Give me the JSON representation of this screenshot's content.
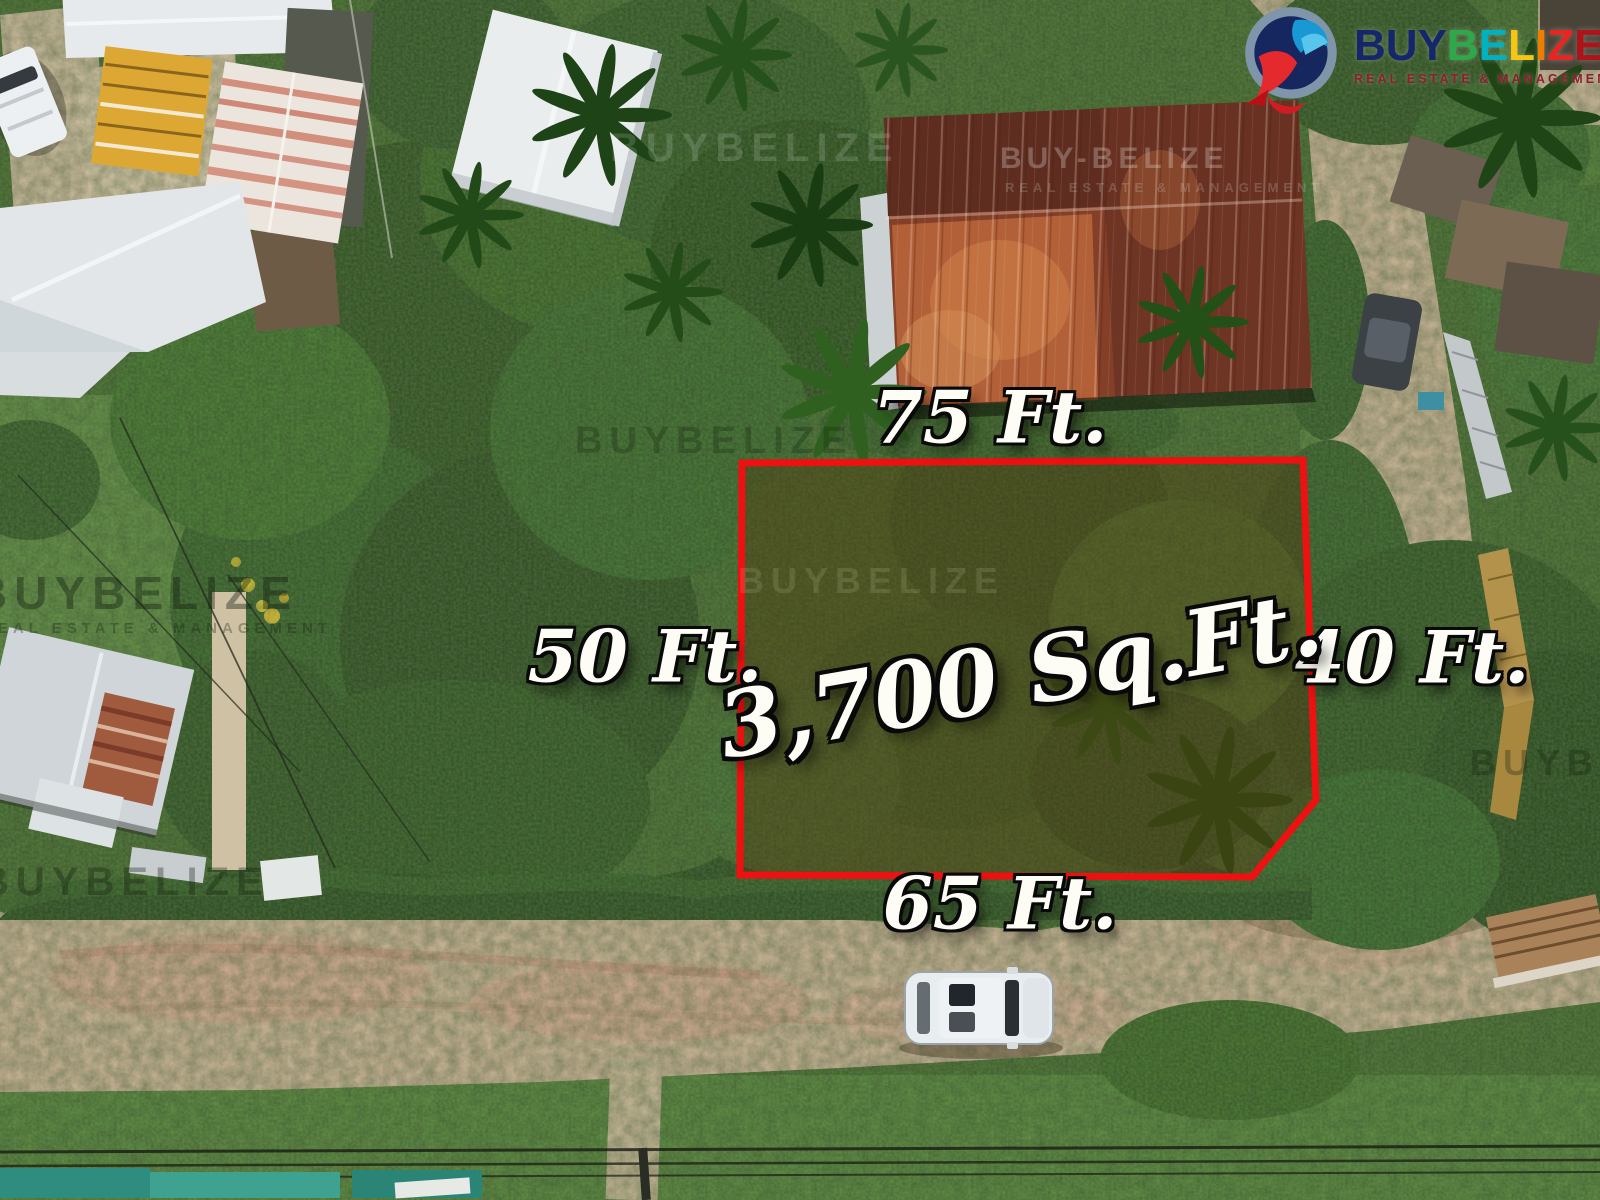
{
  "brand": {
    "logo_text": "BUYBELIZE",
    "letters": [
      {
        "char": "B",
        "color": "#15266b"
      },
      {
        "char": "U",
        "color": "#15266b"
      },
      {
        "char": "Y",
        "color": "#15266b"
      },
      {
        "char": "B",
        "color": "#2fa84c"
      },
      {
        "char": "E",
        "color": "#00b2c0"
      },
      {
        "char": "L",
        "color": "#f6c612"
      },
      {
        "char": "I",
        "color": "#ef7d00"
      },
      {
        "char": "Z",
        "color": "#e8251f"
      },
      {
        "char": "E",
        "color": "#b01219"
      }
    ],
    "tagline": "REAL ESTATE & MANAGEMENT",
    "icon": "toucan-bird-logo"
  },
  "annotations": {
    "area": "3,700 Sq.Ft.",
    "side_top": "75 Ft.",
    "side_left": "50 Ft.",
    "side_right": "40 Ft.",
    "side_bottom": "65 Ft.",
    "boundary_color": "#ee1111"
  },
  "watermarks": {
    "primary": "BUYBELIZE",
    "roof": "BUY-BELIZE",
    "tagline": "REAL ESTATE & MANAGEMENT"
  },
  "scene": {
    "description": "Aerial drone photo of a vacant 3,700 sq ft lot outlined in red, surrounded by houses with metal roofs, trees, palms and dirt roads; white SUV parked on the road below the lot."
  }
}
